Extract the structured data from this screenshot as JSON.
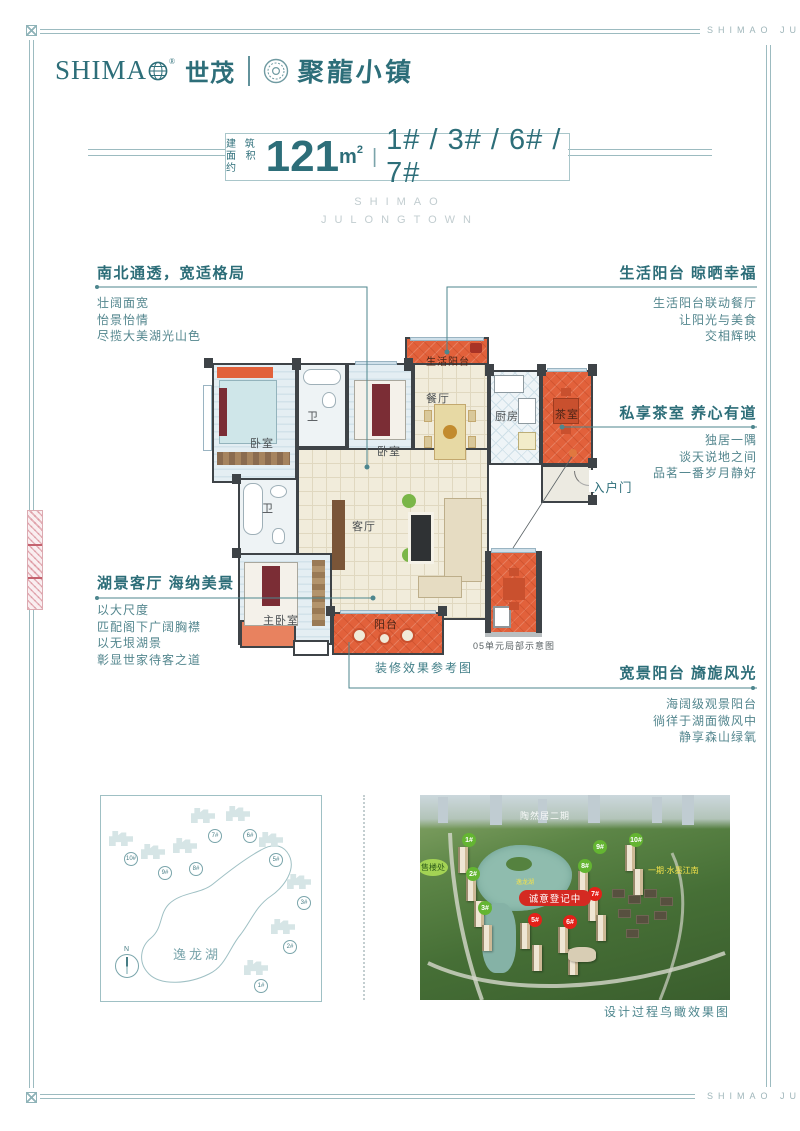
{
  "brand": {
    "name_en": "SHIMA",
    "reg": "®",
    "name_cn": "世茂",
    "project": "聚龍小镇"
  },
  "header": {
    "area_prefix_top": "建 筑",
    "area_prefix_bottom": "面积约",
    "area_value": "121",
    "area_unit": "m",
    "area_sup": "2",
    "pipe": "|",
    "buildings": "1# / 3# / 6# / 7#",
    "subtitle_line1": "SHIMAO",
    "subtitle_line2": "JULONGTOWN"
  },
  "callouts": {
    "c1": {
      "title": "南北通透，宽适格局",
      "line1": "壮阔面宽",
      "line2": "怡景怡情",
      "line3": "尽揽大美湖光山色"
    },
    "c2": {
      "title": "生活阳台 晾晒幸福",
      "line1": "生活阳台联动餐厅",
      "line2": "让阳光与美食",
      "line3": "交相辉映"
    },
    "c3": {
      "title": "私享茶室 养心有道",
      "line1": "独居一隅",
      "line2": "谈天说地之间",
      "line3": "品茗一番岁月静好"
    },
    "c4": {
      "title": "湖景客厅 海纳美景",
      "line1": "以大尺度",
      "line2": "匹配阁下广阔胸襟",
      "line3": "以无垠湖景",
      "line4": "彰显世家待客之道"
    },
    "c5": {
      "title": "宽景阳台 旖旎风光",
      "line1": "海阔级观景阳台",
      "line2": "徜徉于湖面微风中",
      "line3": "静享森山绿氧"
    }
  },
  "floorplan": {
    "rooms": {
      "life_balcony": "生活阳台",
      "bedroom1": "卧室",
      "bath1": "卫",
      "bedroom2": "卧室",
      "dining": "餐厅",
      "kitchen": "厨房",
      "tea": "茶室",
      "living": "客厅",
      "bath2": "卫",
      "master": "主卧室",
      "balcony": "阳台"
    },
    "entry_arrow": "⇦",
    "entry_label": "入户门",
    "decor_caption": "装修效果参考图",
    "unit_caption": "05单元局部示意图"
  },
  "site_map": {
    "lake": "逸龙湖",
    "north": "N",
    "buildings": [
      {
        "label": "10#"
      },
      {
        "label": "9#"
      },
      {
        "label": "8#"
      },
      {
        "label": "7#"
      },
      {
        "label": "6#"
      },
      {
        "label": "5#"
      },
      {
        "label": "3#"
      },
      {
        "label": "2#"
      },
      {
        "label": "1#"
      }
    ]
  },
  "aerial": {
    "top_label": "陶然居二期",
    "sales_office": "售楼处",
    "banner": "诚意登记中",
    "side_label": "一期·水墨江南",
    "lake_label": "逸龙湖",
    "green_markers": [
      "1#",
      "2#",
      "3#",
      "8#",
      "9#",
      "10#"
    ],
    "red_markers": [
      "5#",
      "6#",
      "7#"
    ],
    "caption": "设计过程鸟瞰效果图"
  },
  "frame": {
    "watermark_top": "SHIMAO JU",
    "watermark_bottom": "SHIMAO JU"
  },
  "colors": {
    "teal": "#2d6e79",
    "line": "#4d868e",
    "orange": "#e2613b",
    "marker_green": "#64b532",
    "marker_red": "#e32119"
  }
}
